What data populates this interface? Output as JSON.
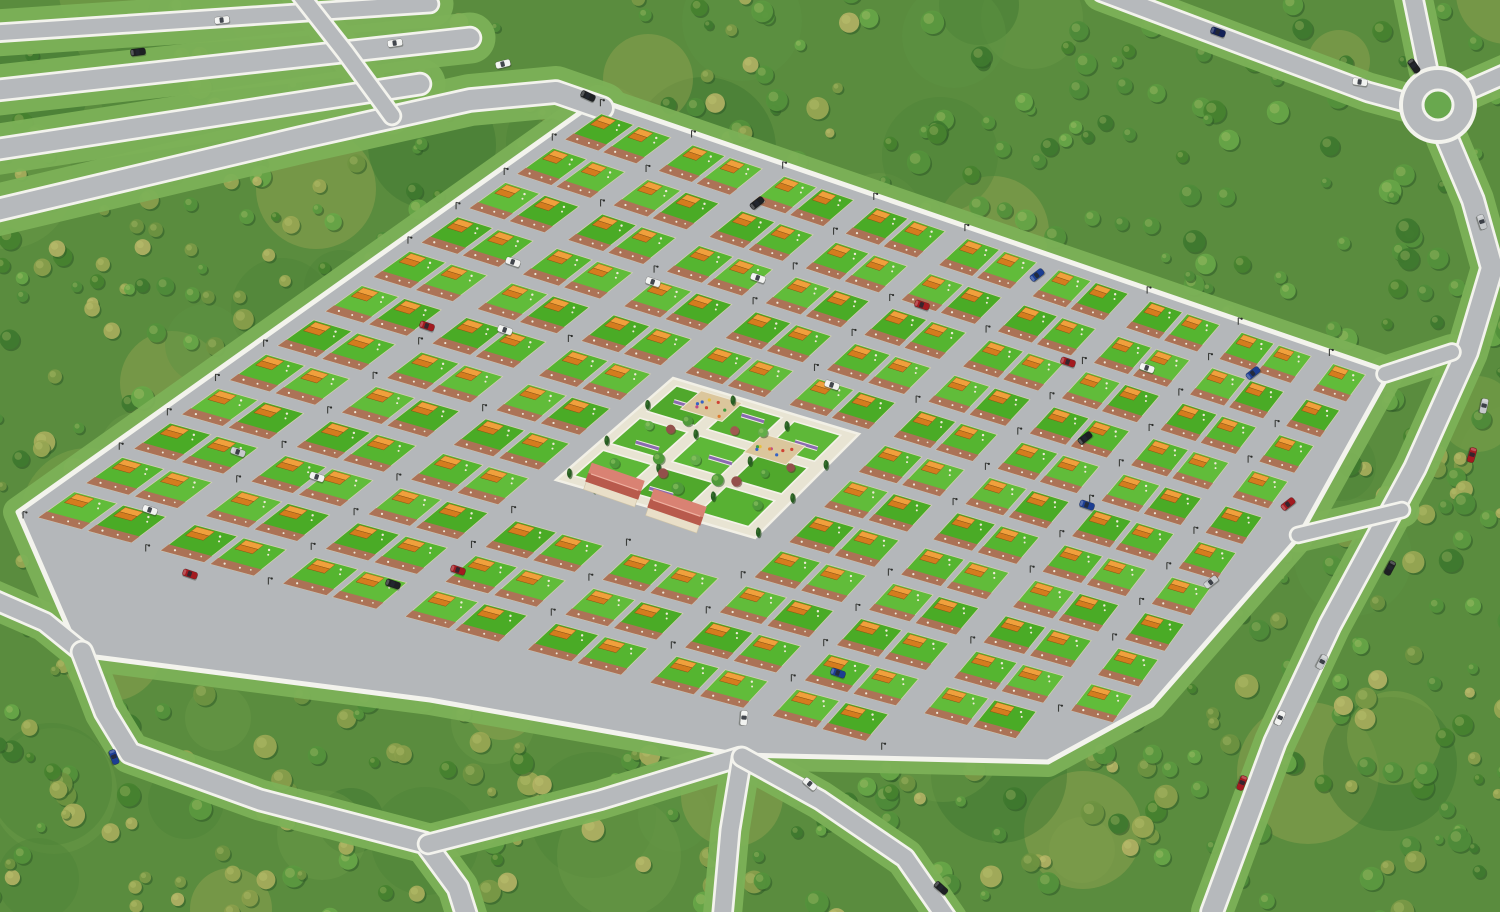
{
  "scene": {
    "title": "Residential Development Master Plan — Aerial 3D Render",
    "description": "Bird's-eye 3D visualization of a suburban housing estate: identical orange-roofed cottages on green plots arranged in diagonal blocks around a landscaped central park, set in dense forest with perimeter roads and a roundabout.",
    "environment": "dense mixed-green forest",
    "view": "high-angle oblique aerial perspective"
  },
  "palette": {
    "forest_base": "#5a8c3e",
    "forest_dark": "#3f7a2f",
    "forest_olive": "#8ba04c",
    "forest_yellow": "#a8ae5c",
    "grass_verge": "#7cb157",
    "road_asphalt": "#b6b9bc",
    "road_curb": "#f3f3ed",
    "estate_pavement": "#b4b7ba",
    "lawn_green": "#55b530",
    "roof_orange_light": "#f0a03c",
    "roof_orange_dark": "#d47c1e",
    "patio_brick": "#b06f58",
    "park_stone": "#e8e4d3",
    "park_lawn": "#58b133",
    "pavilion_roof": "#c96a5a",
    "flower_bed_purple": "#8a6bb0",
    "conifer_green": "#275d22",
    "red_tree": "#93504b",
    "playground_sand": "#dbc69c",
    "roundabout_island": "#69a84e"
  },
  "housing": {
    "label": "housing estate",
    "block_columns": 9,
    "row_strips": 12,
    "plots_per_block_row": 2,
    "approx_house_count": 190,
    "house_style": "single-storey gable-roof cottage with front lawn and brick patio"
  },
  "central_park": {
    "label": "central park",
    "lawn_parcels": 9,
    "playgrounds": 2,
    "pavilions": 2,
    "flower_beds": 6,
    "trees": {
      "conifers": 14,
      "green": 10,
      "red_leaf": 6
    }
  },
  "roundabout": {
    "label": "roundabout",
    "center_x": 1438,
    "center_y": 105,
    "island": "grass circle"
  },
  "roads": [
    "top-left-avenue-1",
    "top-left-avenue-2",
    "top-left-avenue-3",
    "estate-entrance-avenue",
    "top-left-crossing-road",
    "roundabout-west-road",
    "roundabout-north-road",
    "roundabout-east-road",
    "east-perimeter-road",
    "southwest-feeder-road",
    "southwest-exit-road",
    "south-connector-road",
    "south-exit-road",
    "southeast-exit-road",
    "northeast-link-road",
    "east-link-road"
  ],
  "street_lamps": {
    "style": "single-arm pole",
    "approx_count": 70
  },
  "car_colors": {
    "white": "#f1f2f0",
    "silver": "#c6c9cb",
    "black": "#1e2023",
    "red": "#a31a20",
    "blue": "#1c3e93",
    "darkblue": "#122057"
  },
  "cars": [
    {
      "c": "white",
      "x": 222,
      "y": 20,
      "a": -7
    },
    {
      "c": "white",
      "x": 395,
      "y": 43,
      "a": -8
    },
    {
      "c": "black",
      "x": 138,
      "y": 52,
      "a": -7
    },
    {
      "c": "white",
      "x": 503,
      "y": 64,
      "a": -14
    },
    {
      "c": "black",
      "x": 588,
      "y": 96,
      "a": 25
    },
    {
      "c": "darkblue",
      "x": 1218,
      "y": 32,
      "a": 20
    },
    {
      "c": "black",
      "x": 1414,
      "y": 66,
      "a": 55
    },
    {
      "c": "white",
      "x": 1360,
      "y": 82,
      "a": 8
    },
    {
      "c": "silver",
      "x": 1482,
      "y": 222,
      "a": 72
    },
    {
      "c": "silver",
      "x": 1484,
      "y": 406,
      "a": 102
    },
    {
      "c": "red",
      "x": 1472,
      "y": 455,
      "a": 106
    },
    {
      "c": "black",
      "x": 1390,
      "y": 568,
      "a": 118
    },
    {
      "c": "silver",
      "x": 1322,
      "y": 662,
      "a": 118
    },
    {
      "c": "white",
      "x": 1280,
      "y": 718,
      "a": 115
    },
    {
      "c": "red",
      "x": 1242,
      "y": 783,
      "a": 112
    },
    {
      "c": "red",
      "x": 1288,
      "y": 504,
      "a": -38
    },
    {
      "c": "silver",
      "x": 1211,
      "y": 582,
      "a": -38
    },
    {
      "c": "blue",
      "x": 838,
      "y": 673,
      "a": 19
    },
    {
      "c": "white",
      "x": 744,
      "y": 718,
      "a": 95
    },
    {
      "c": "white",
      "x": 810,
      "y": 784,
      "a": 40
    },
    {
      "c": "black",
      "x": 941,
      "y": 888,
      "a": 42
    },
    {
      "c": "blue",
      "x": 114,
      "y": 757,
      "a": 70
    },
    {
      "c": "red",
      "x": 190,
      "y": 574,
      "a": 19
    },
    {
      "c": "white",
      "x": 150,
      "y": 510,
      "a": 19
    },
    {
      "c": "silver",
      "x": 238,
      "y": 452,
      "a": 19
    },
    {
      "c": "white",
      "x": 317,
      "y": 477,
      "a": 19
    },
    {
      "c": "white",
      "x": 513,
      "y": 262,
      "a": 19
    },
    {
      "c": "red",
      "x": 427,
      "y": 326,
      "a": 19
    },
    {
      "c": "white",
      "x": 505,
      "y": 330,
      "a": 19
    },
    {
      "c": "white",
      "x": 653,
      "y": 282,
      "a": 19
    },
    {
      "c": "black",
      "x": 757,
      "y": 203,
      "a": -38
    },
    {
      "c": "white",
      "x": 758,
      "y": 278,
      "a": 19
    },
    {
      "c": "blue",
      "x": 1037,
      "y": 275,
      "a": -38
    },
    {
      "c": "red",
      "x": 922,
      "y": 305,
      "a": 19
    },
    {
      "c": "black",
      "x": 1085,
      "y": 438,
      "a": -38
    },
    {
      "c": "red",
      "x": 1068,
      "y": 362,
      "a": 19
    },
    {
      "c": "white",
      "x": 1147,
      "y": 368,
      "a": 19
    },
    {
      "c": "blue",
      "x": 1253,
      "y": 373,
      "a": -38
    },
    {
      "c": "white",
      "x": 832,
      "y": 385,
      "a": 19
    },
    {
      "c": "blue",
      "x": 1087,
      "y": 505,
      "a": 19
    },
    {
      "c": "black",
      "x": 393,
      "y": 584,
      "a": 19
    },
    {
      "c": "red",
      "x": 458,
      "y": 570,
      "a": 19
    }
  ]
}
